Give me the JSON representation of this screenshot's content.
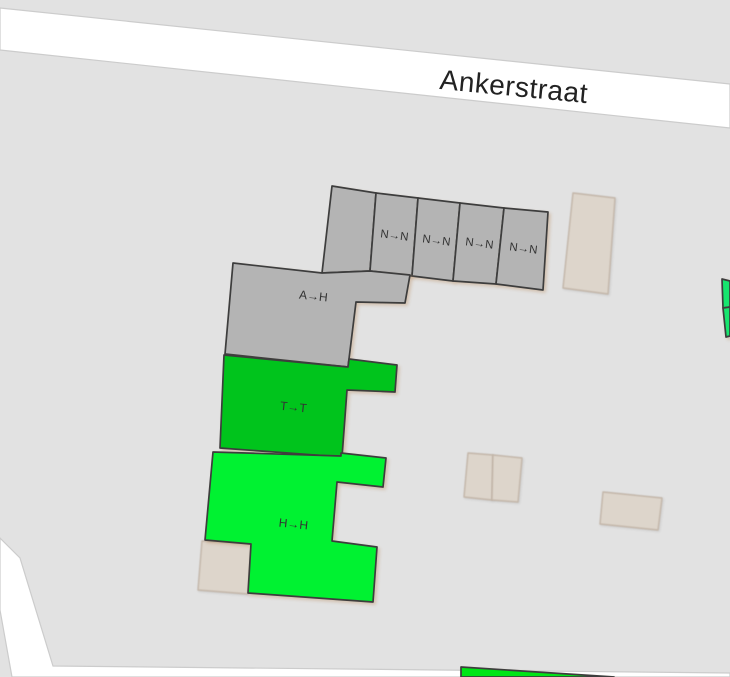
{
  "map": {
    "street": {
      "name": "Ankerstraat"
    },
    "features": {
      "terrace_units": [
        {
          "label": "N→N"
        },
        {
          "label": "N→N"
        },
        {
          "label": "N→N"
        },
        {
          "label": "N→N"
        }
      ],
      "block_a": {
        "label": "A→H"
      },
      "block_t": {
        "label": "T→T"
      },
      "block_h": {
        "label": "H→H"
      }
    },
    "colors": {
      "background": "#e2e2e2",
      "road_fill": "#ffffff",
      "road_casing": "#cccccc",
      "building_tagged_fill": "#b4b4b4",
      "building_outline": "#3d3d3d",
      "building_untagged_fill": "#ddd5cb",
      "building_untagged_outline": "#c3b6a9",
      "green_dark": "#00c41c",
      "green_bright": "#00f231",
      "green_teal": "#16e56e",
      "green_bottom": "#00e516",
      "label_color": "#333333",
      "street_label_color": "#222222"
    }
  }
}
